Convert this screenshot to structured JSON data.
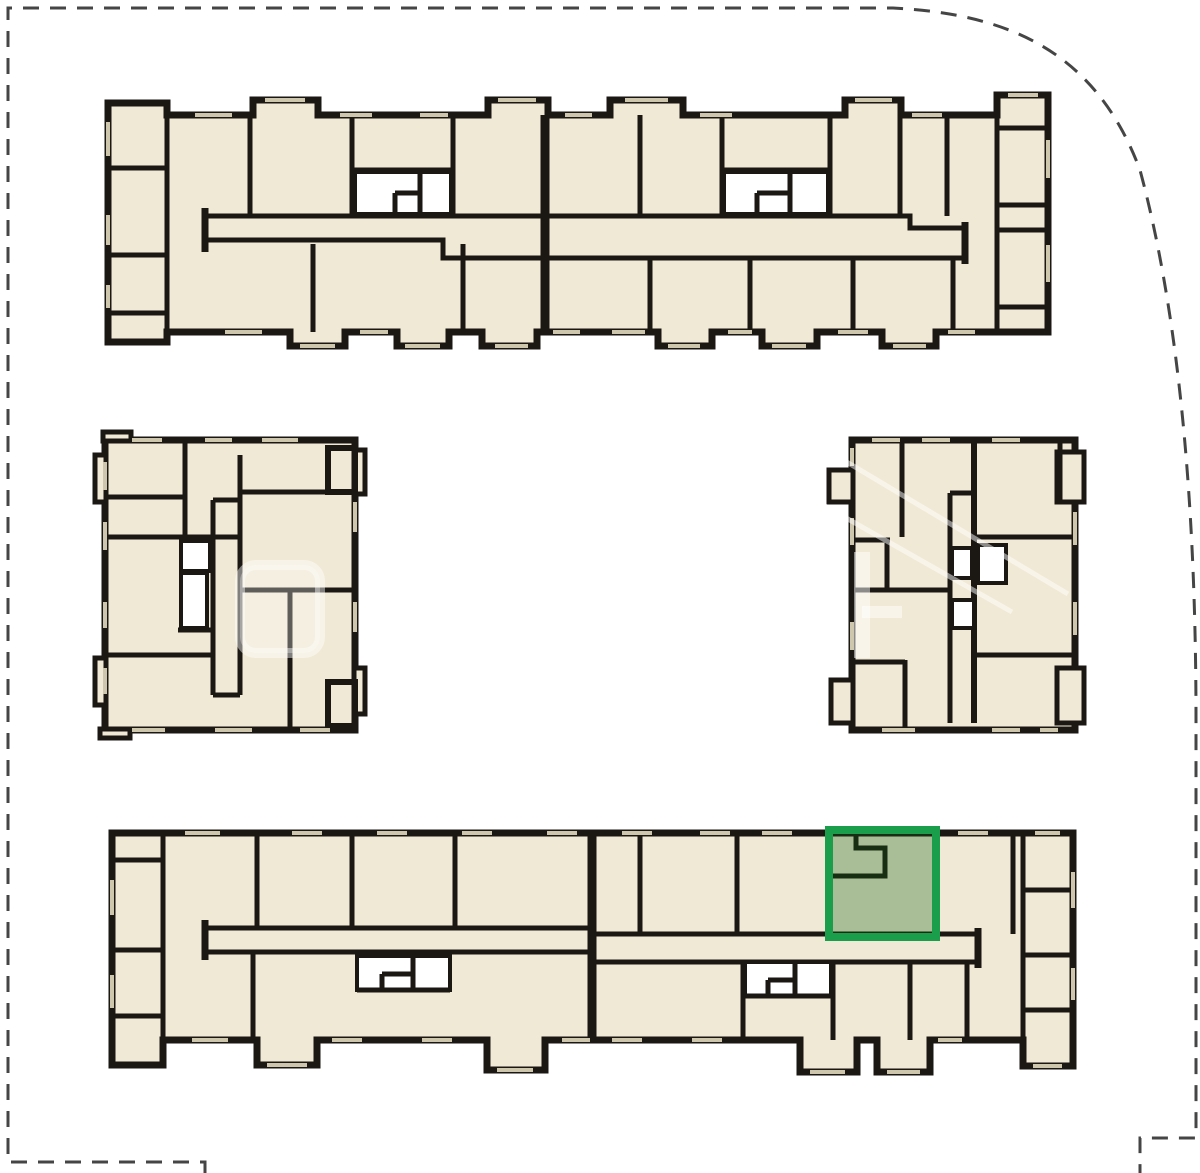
{
  "title": "Residential complex site plan with selected unit highlighted",
  "canvas": {
    "w": 1200,
    "h": 1173
  },
  "colors": {
    "room": "#f0e9d5",
    "wall": "#1b1713",
    "win": "#cfc7ad",
    "boundary": "#454545",
    "hl_stroke": "#1b9e4b",
    "hl_fill": "rgba(18,96,20,0.32)"
  },
  "selected_unit": {
    "x": 829,
    "y": 830,
    "w": 107,
    "h": 107,
    "building": "building-bottom",
    "status_color": "#1b9e4b"
  },
  "groups": [
    {
      "key": "bt",
      "id": "building-top",
      "interactable": false
    },
    {
      "key": "bb",
      "id": "building-bottom",
      "interactable": false
    },
    {
      "key": "bl",
      "id": "building-mid-left",
      "interactable": false
    },
    {
      "key": "br",
      "id": "building-mid-right",
      "interactable": false
    },
    {
      "key": "wm",
      "id": "watermark",
      "interactable": false
    },
    {
      "key": "su",
      "id": "selected-unit-highlight",
      "interactable": true
    },
    {
      "key": "sb",
      "id": "site-boundary",
      "interactable": false
    }
  ],
  "shapes": [
    {
      "g": "bt",
      "t": "path",
      "c": "room",
      "d": "M108,103 H167 V115 H253 V100 H318 V115 H488 V100 H548 V115 H610 V100 H683 V115 H845 V100 H901 V115 H997 V95 H1048 V332 H936 V346 H882 V332 H817 V346 H762 V332 H712 V346 H658 V332 H537 V346 H482 V332 H449 V346 H397 V332 H345 V346 H290 V332 H167 V342 H108 Z"
    },
    {
      "g": "bt",
      "t": "path",
      "c": "wall",
      "d": "M205,216 H910 V228 H965"
    },
    {
      "g": "bt",
      "t": "path",
      "c": "wall",
      "d": "M205,240 H443 V258 H965"
    },
    {
      "g": "bt",
      "t": "path",
      "c": "wall",
      "sw": 7,
      "d": "M205,208 V252"
    },
    {
      "g": "bt",
      "t": "path",
      "c": "wall",
      "sw": 7,
      "d": "M965,222 V264"
    },
    {
      "g": "bt",
      "t": "path",
      "c": "wall",
      "sw": 9,
      "d": "M545,115 V332"
    },
    {
      "g": "bt",
      "t": "path",
      "c": "wall",
      "d": "M167,103 V342"
    },
    {
      "g": "bt",
      "t": "path",
      "c": "wall",
      "d": "M250,115 V216"
    },
    {
      "g": "bt",
      "t": "path",
      "c": "wall",
      "d": "M352,115 V216"
    },
    {
      "g": "bt",
      "t": "path",
      "c": "wall",
      "d": "M453,115 V216"
    },
    {
      "g": "bt",
      "t": "path",
      "c": "wall",
      "d": "M640,115 V216"
    },
    {
      "g": "bt",
      "t": "path",
      "c": "wall",
      "d": "M722,115 V216"
    },
    {
      "g": "bt",
      "t": "path",
      "c": "wall",
      "d": "M830,115 V216"
    },
    {
      "g": "bt",
      "t": "path",
      "c": "wall",
      "d": "M900,115 V216"
    },
    {
      "g": "bt",
      "t": "path",
      "c": "wall",
      "d": "M947,115 V216"
    },
    {
      "g": "bt",
      "t": "path",
      "c": "wall",
      "d": "M997,95 V332"
    },
    {
      "g": "bt",
      "t": "rect",
      "c": "white",
      "x": 355,
      "y": 172,
      "w": 96,
      "h": 42
    },
    {
      "g": "bt",
      "t": "rect",
      "c": "white",
      "x": 724,
      "y": 172,
      "w": 104,
      "h": 42
    },
    {
      "g": "bt",
      "t": "path",
      "c": "wall",
      "d": "M352,170 H453"
    },
    {
      "g": "bt",
      "t": "path",
      "c": "wall",
      "d": "M722,170 H830"
    },
    {
      "g": "bt",
      "t": "path",
      "c": "wall",
      "d": "M420,172 V214"
    },
    {
      "g": "bt",
      "t": "path",
      "c": "wall",
      "d": "M395,193 H420 M395,193 V214"
    },
    {
      "g": "bt",
      "t": "path",
      "c": "wall",
      "d": "M790,172 V214"
    },
    {
      "g": "bt",
      "t": "path",
      "c": "wall",
      "d": "M757,193 H790 M757,193 V214"
    },
    {
      "g": "bt",
      "t": "path",
      "c": "wall",
      "d": "M313,244 V332"
    },
    {
      "g": "bt",
      "t": "path",
      "c": "wall",
      "d": "M463,244 V332"
    },
    {
      "g": "bt",
      "t": "path",
      "c": "wall",
      "d": "M650,258 V332"
    },
    {
      "g": "bt",
      "t": "path",
      "c": "wall",
      "d": "M750,258 V332"
    },
    {
      "g": "bt",
      "t": "path",
      "c": "wall",
      "d": "M853,258 V332"
    },
    {
      "g": "bt",
      "t": "path",
      "c": "wall",
      "d": "M953,258 V332"
    },
    {
      "g": "bt",
      "t": "path",
      "c": "wall",
      "d": "M108,168 H167 M108,255 H167 M108,313 H167"
    },
    {
      "g": "bt",
      "t": "path",
      "c": "wall",
      "d": "M997,128 H1048 M997,205 H1048 M997,230 H1048 M997,307 H1048"
    },
    {
      "g": "bt",
      "t": "path",
      "c": "win",
      "d": "M195,115 H232 M340,115 H372 M420,115 H448 M565,115 H592 M700,115 H732 M912,115 H942"
    },
    {
      "g": "bt",
      "t": "path",
      "c": "win",
      "d": "M265,100 H305 M498,100 H536 M625,100 H668 M855,100 H892 M1008,95 H1038"
    },
    {
      "g": "bt",
      "t": "path",
      "c": "win",
      "d": "M225,332 H262 M360,332 H388 M553,332 H580 M612,332 H645 M728,332 H752 M838,332 H868 M948,332 H975"
    },
    {
      "g": "bt",
      "t": "path",
      "c": "win",
      "d": "M300,346 H335 M405,346 H440 M495,346 H528 M668,346 H700 M772,346 H806 M893,346 H926"
    },
    {
      "g": "bt",
      "t": "path",
      "c": "win",
      "d": "M108,122 V156 M108,215 V245 M108,285 V308"
    },
    {
      "g": "bt",
      "t": "path",
      "c": "win",
      "d": "M1048,140 V178 M1048,245 V282"
    },
    {
      "g": "bb",
      "t": "path",
      "c": "room",
      "d": "M112,833 H1073 V1066 H1023 V1040 H930 V1072 H877 V1040 H857 V1072 H800 V1040 H545 V1070 H487 V1040 H317 V1065 H257 V1040 H163 V1065 H112 Z"
    },
    {
      "g": "bb",
      "t": "path",
      "c": "wall",
      "d": "M205,928 H592 V934 H978"
    },
    {
      "g": "bb",
      "t": "path",
      "c": "wall",
      "d": "M205,952 H592 V962 H978"
    },
    {
      "g": "bb",
      "t": "path",
      "c": "wall",
      "sw": 7,
      "d": "M205,920 V960"
    },
    {
      "g": "bb",
      "t": "path",
      "c": "wall",
      "sw": 7,
      "d": "M978,928 V968"
    },
    {
      "g": "bb",
      "t": "path",
      "c": "wall",
      "sw": 9,
      "d": "M592,833 V1040"
    },
    {
      "g": "bb",
      "t": "path",
      "c": "wall",
      "d": "M163,833 V1065"
    },
    {
      "g": "bb",
      "t": "path",
      "c": "wall",
      "d": "M257,833 V928"
    },
    {
      "g": "bb",
      "t": "path",
      "c": "wall",
      "d": "M352,833 V928"
    },
    {
      "g": "bb",
      "t": "path",
      "c": "wall",
      "d": "M455,833 V928"
    },
    {
      "g": "bb",
      "t": "path",
      "c": "wall",
      "d": "M640,833 V934"
    },
    {
      "g": "bb",
      "t": "path",
      "c": "wall",
      "d": "M737,833 V934"
    },
    {
      "g": "bb",
      "t": "path",
      "c": "wall",
      "d": "M829,833 V934"
    },
    {
      "g": "bb",
      "t": "path",
      "c": "wall",
      "d": "M936,833 V934"
    },
    {
      "g": "bb",
      "t": "path",
      "c": "wall",
      "d": "M1013,833 V934"
    },
    {
      "g": "bb",
      "t": "path",
      "c": "wall",
      "d": "M1023,833 V1066"
    },
    {
      "g": "bb",
      "t": "path",
      "c": "wall",
      "d": "M253,952 V1040"
    },
    {
      "g": "bb",
      "t": "path",
      "c": "wall",
      "d": "M743,962 V1040"
    },
    {
      "g": "bb",
      "t": "path",
      "c": "wall",
      "d": "M833,962 V1040"
    },
    {
      "g": "bb",
      "t": "path",
      "c": "wall",
      "d": "M910,962 V1040"
    },
    {
      "g": "bb",
      "t": "path",
      "c": "wall",
      "d": "M967,962 V1040"
    },
    {
      "g": "bb",
      "t": "rect",
      "c": "white",
      "x": 357,
      "y": 956,
      "w": 93,
      "h": 34
    },
    {
      "g": "bb",
      "t": "rect",
      "c": "white",
      "x": 745,
      "y": 962,
      "w": 86,
      "h": 34
    },
    {
      "g": "bb",
      "t": "path",
      "c": "wall",
      "d": "M413,956 V990"
    },
    {
      "g": "bb",
      "t": "path",
      "c": "wall",
      "d": "M382,974 H413 M382,974 V990"
    },
    {
      "g": "bb",
      "t": "path",
      "c": "wall",
      "d": "M357,990 H450"
    },
    {
      "g": "bb",
      "t": "path",
      "c": "wall",
      "d": "M795,962 V996"
    },
    {
      "g": "bb",
      "t": "path",
      "c": "wall",
      "d": "M768,980 H795 M768,980 V996"
    },
    {
      "g": "bb",
      "t": "path",
      "c": "wall",
      "d": "M745,996 H831"
    },
    {
      "g": "bb",
      "t": "path",
      "c": "wall",
      "d": "M112,860 H163 M112,950 H163 M112,1016 H163"
    },
    {
      "g": "bb",
      "t": "path",
      "c": "wall",
      "d": "M1023,890 H1073 M1023,955 H1073 M1023,1010 H1073"
    },
    {
      "g": "bb",
      "t": "path",
      "c": "wall",
      "d": "M832,876 H885 V848 H856 V834"
    },
    {
      "g": "bb",
      "t": "path",
      "c": "win",
      "d": "M185,833 H220 M292,833 H322 M377,833 H407 M462,833 H492 M547,833 H577 M622,833 H652 M700,833 H730 M762,833 H792 M958,833 H988 M1035,833 H1060"
    },
    {
      "g": "bb",
      "t": "path",
      "c": "win",
      "d": "M192,1040 H228 M332,1040 H362 M422,1040 H452 M562,1040 H590 M612,1040 H642 M692,1040 H722 M938,1040 H962"
    },
    {
      "g": "bb",
      "t": "path",
      "c": "win",
      "d": "M267,1065 H307 M497,1070 H533 M810,1072 H845 M887,1072 H920 M1033,1066 H1062"
    },
    {
      "g": "bb",
      "t": "path",
      "c": "win",
      "d": "M112,880 V915 M112,975 V1008"
    },
    {
      "g": "bb",
      "t": "path",
      "c": "win",
      "d": "M1073,872 V908 M1073,968 V1000"
    },
    {
      "g": "bl",
      "t": "path",
      "c": "room",
      "d": "M105,440 H355 V730 H105 Z"
    },
    {
      "g": "bl",
      "t": "rect",
      "c": "room",
      "sw": 5,
      "x": 95,
      "y": 455,
      "w": 11,
      "h": 47
    },
    {
      "g": "bl",
      "t": "rect",
      "c": "room",
      "sw": 5,
      "x": 95,
      "y": 658,
      "w": 11,
      "h": 47
    },
    {
      "g": "bl",
      "t": "rect",
      "c": "room",
      "sw": 5,
      "x": 354,
      "y": 450,
      "w": 11,
      "h": 44
    },
    {
      "g": "bl",
      "t": "rect",
      "c": "room",
      "sw": 5,
      "x": 354,
      "y": 668,
      "w": 11,
      "h": 46
    },
    {
      "g": "bl",
      "t": "rect",
      "c": "room",
      "sw": 5,
      "x": 103,
      "y": 432,
      "w": 28,
      "h": 9
    },
    {
      "g": "bl",
      "t": "rect",
      "c": "room",
      "sw": 5,
      "x": 100,
      "y": 729,
      "w": 30,
      "h": 9
    },
    {
      "g": "bl",
      "t": "path",
      "c": "wall",
      "d": "M185,440 V537"
    },
    {
      "g": "bl",
      "t": "path",
      "c": "wall",
      "d": "M105,537 H240"
    },
    {
      "g": "bl",
      "t": "path",
      "c": "wall",
      "d": "M105,497 H185"
    },
    {
      "g": "bl",
      "t": "path",
      "c": "wall",
      "d": "M213,500 V695 M213,500 H240"
    },
    {
      "g": "bl",
      "t": "path",
      "c": "wall",
      "d": "M240,455 V695"
    },
    {
      "g": "bl",
      "t": "path",
      "c": "wall",
      "d": "M213,695 H240"
    },
    {
      "g": "bl",
      "t": "path",
      "c": "wall",
      "d": "M240,492 H355"
    },
    {
      "g": "bl",
      "t": "path",
      "c": "wall",
      "d": "M240,590 H355"
    },
    {
      "g": "bl",
      "t": "path",
      "c": "wall",
      "d": "M105,655 H213"
    },
    {
      "g": "bl",
      "t": "path",
      "c": "wall",
      "d": "M290,590 V730"
    },
    {
      "g": "bl",
      "t": "path",
      "c": "wall",
      "d": "M178,630 H213"
    },
    {
      "g": "bl",
      "t": "path",
      "c": "wall",
      "sw": 6,
      "d": "M328,448 h27 v44 h-27 Z"
    },
    {
      "g": "bl",
      "t": "path",
      "c": "wall",
      "sw": 6,
      "d": "M328,682 h27 v44 h-27 Z"
    },
    {
      "g": "bl",
      "t": "rect",
      "c": "white",
      "x": 181,
      "y": 541,
      "w": 29,
      "h": 30
    },
    {
      "g": "bl",
      "t": "rect",
      "c": "white",
      "x": 181,
      "y": 573,
      "w": 26,
      "h": 55
    },
    {
      "g": "bl",
      "t": "path",
      "c": "win",
      "d": "M132,440 H162 M205,440 H232 M262,440 H298"
    },
    {
      "g": "bl",
      "t": "path",
      "c": "win",
      "d": "M132,730 H165 M215,730 H252 M300,730 H330"
    },
    {
      "g": "bl",
      "t": "path",
      "c": "win",
      "d": "M105,462 V490 M105,522 V550 M105,602 V628 M105,668 V694"
    },
    {
      "g": "bl",
      "t": "path",
      "c": "win",
      "d": "M355,502 V532 M355,602 V632"
    },
    {
      "g": "br",
      "t": "path",
      "c": "room",
      "d": "M852,440 H1075 V730 H852 Z"
    },
    {
      "g": "br",
      "t": "rect",
      "c": "room",
      "sw": 5,
      "x": 829,
      "y": 470,
      "w": 24,
      "h": 32
    },
    {
      "g": "br",
      "t": "rect",
      "c": "room",
      "sw": 5,
      "x": 831,
      "y": 680,
      "w": 22,
      "h": 43
    },
    {
      "g": "br",
      "t": "rect",
      "c": "room",
      "sw": 5,
      "x": 1057,
      "y": 452,
      "w": 27,
      "h": 50
    },
    {
      "g": "br",
      "t": "rect",
      "c": "room",
      "sw": 5,
      "x": 1057,
      "y": 668,
      "w": 27,
      "h": 55
    },
    {
      "g": "br",
      "t": "path",
      "c": "wall",
      "sw": 6,
      "d": "M974,440 V723"
    },
    {
      "g": "br",
      "t": "path",
      "c": "wall",
      "d": "M950,493 V723 M950,493 H974"
    },
    {
      "g": "br",
      "t": "path",
      "c": "wall",
      "d": "M902,440 V537"
    },
    {
      "g": "br",
      "t": "path",
      "c": "wall",
      "d": "M852,540 H890"
    },
    {
      "g": "br",
      "t": "path",
      "c": "wall",
      "d": "M887,540 V588"
    },
    {
      "g": "br",
      "t": "path",
      "c": "wall",
      "d": "M974,537 H1075"
    },
    {
      "g": "br",
      "t": "path",
      "c": "wall",
      "d": "M852,590 H950"
    },
    {
      "g": "br",
      "t": "path",
      "c": "wall",
      "d": "M974,655 H1075"
    },
    {
      "g": "br",
      "t": "path",
      "c": "wall",
      "d": "M905,660 V730 M852,662 H905"
    },
    {
      "g": "br",
      "t": "path",
      "c": "wall",
      "d": "M1060,440 V502"
    },
    {
      "g": "br",
      "t": "rect",
      "c": "white",
      "x": 952,
      "y": 548,
      "w": 20,
      "h": 30
    },
    {
      "g": "br",
      "t": "rect",
      "c": "white",
      "x": 978,
      "y": 545,
      "w": 28,
      "h": 38
    },
    {
      "g": "br",
      "t": "rect",
      "c": "white",
      "x": 952,
      "y": 600,
      "w": 22,
      "h": 28
    },
    {
      "g": "br",
      "t": "path",
      "c": "win",
      "d": "M872,440 H900 M922,440 H950 M992,440 H1020"
    },
    {
      "g": "br",
      "t": "path",
      "c": "win",
      "d": "M882,730 H915 M992,730 H1020 M1040,730 H1058"
    },
    {
      "g": "br",
      "t": "path",
      "c": "win",
      "d": "M852,448 V466 M852,518 V545 M852,622 V650"
    },
    {
      "g": "br",
      "t": "path",
      "c": "win",
      "d": "M1075,512 V545 M1075,602 V635"
    },
    {
      "g": "wm",
      "t": "rect",
      "c": "wm-blob",
      "x": 240,
      "y": 565,
      "w": 80,
      "h": 88,
      "rx": 16
    },
    {
      "g": "wm",
      "t": "path",
      "c": "wm-stroke",
      "sw": 16,
      "d": "M862,552 V658"
    },
    {
      "g": "wm",
      "t": "path",
      "c": "wm-stroke",
      "sw": 12,
      "d": "M862,612 H902"
    },
    {
      "g": "wm",
      "t": "path",
      "c": "wm-line",
      "d": "M818,502 L1012,612"
    },
    {
      "g": "wm",
      "t": "path",
      "c": "wm-line",
      "d": "M840,458 L1068,594"
    },
    {
      "g": "su",
      "t": "rect",
      "c": "hl",
      "x": 829,
      "y": 830,
      "w": 107,
      "h": 107
    },
    {
      "g": "sb",
      "t": "path",
      "c": "boundary",
      "d": "M205,1173 V1162 H8 V8 H893 C1010,14 1096,52 1140,170 C1175,300 1196,480 1196,720 V1138 H1140 V1173"
    }
  ]
}
